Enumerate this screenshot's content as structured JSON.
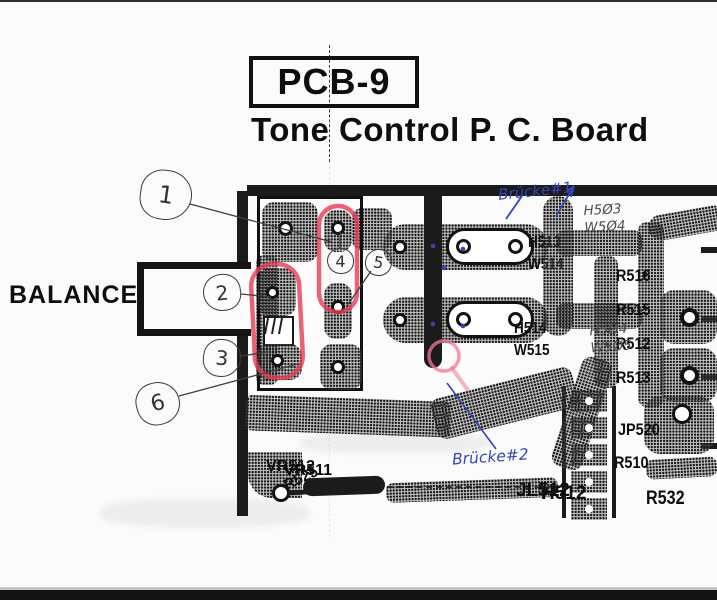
{
  "document": {
    "board_code": "PCB-9",
    "title": "Tone Control P. C. Board",
    "connector_label": "BALANCE"
  },
  "pin_callouts": [
    "1",
    "2",
    "3",
    "4",
    "5",
    "6"
  ],
  "handwriting": {
    "blue": {
      "bridge1": "Brücke#1",
      "bridge2": "Brücke#2"
    },
    "pencil": {
      "note1_line1": "H5Ø3",
      "note1_line2": "W5Ø4",
      "note2_line1": "H5Ø4",
      "note2_line2": "W5Ø5"
    }
  },
  "silkscreen": {
    "vertical_left_1": "VR512",
    "vertical_left_2": "VR511",
    "vertical_mid_1": "JL512",
    "vertical_mid_2": "H512",
    "pair_top_1": "H513",
    "pair_top_2": "W514",
    "pair_mid_1": "H514",
    "pair_mid_2": "W515",
    "right_col_1": "R516",
    "right_col_2": "R515",
    "right_col_3": "R512",
    "right_col_4": "R513",
    "jp_label": "JP520",
    "r51x_label": "R510",
    "r532_label": "R532",
    "diagonal_label": "R525"
  },
  "colors": {
    "marker_red": "#e63c55",
    "marker_pink": "#f27896",
    "pen_blue": "#3746b5",
    "pencil_gray": "#4f4f4f",
    "print_black": "#0e0e0e"
  }
}
